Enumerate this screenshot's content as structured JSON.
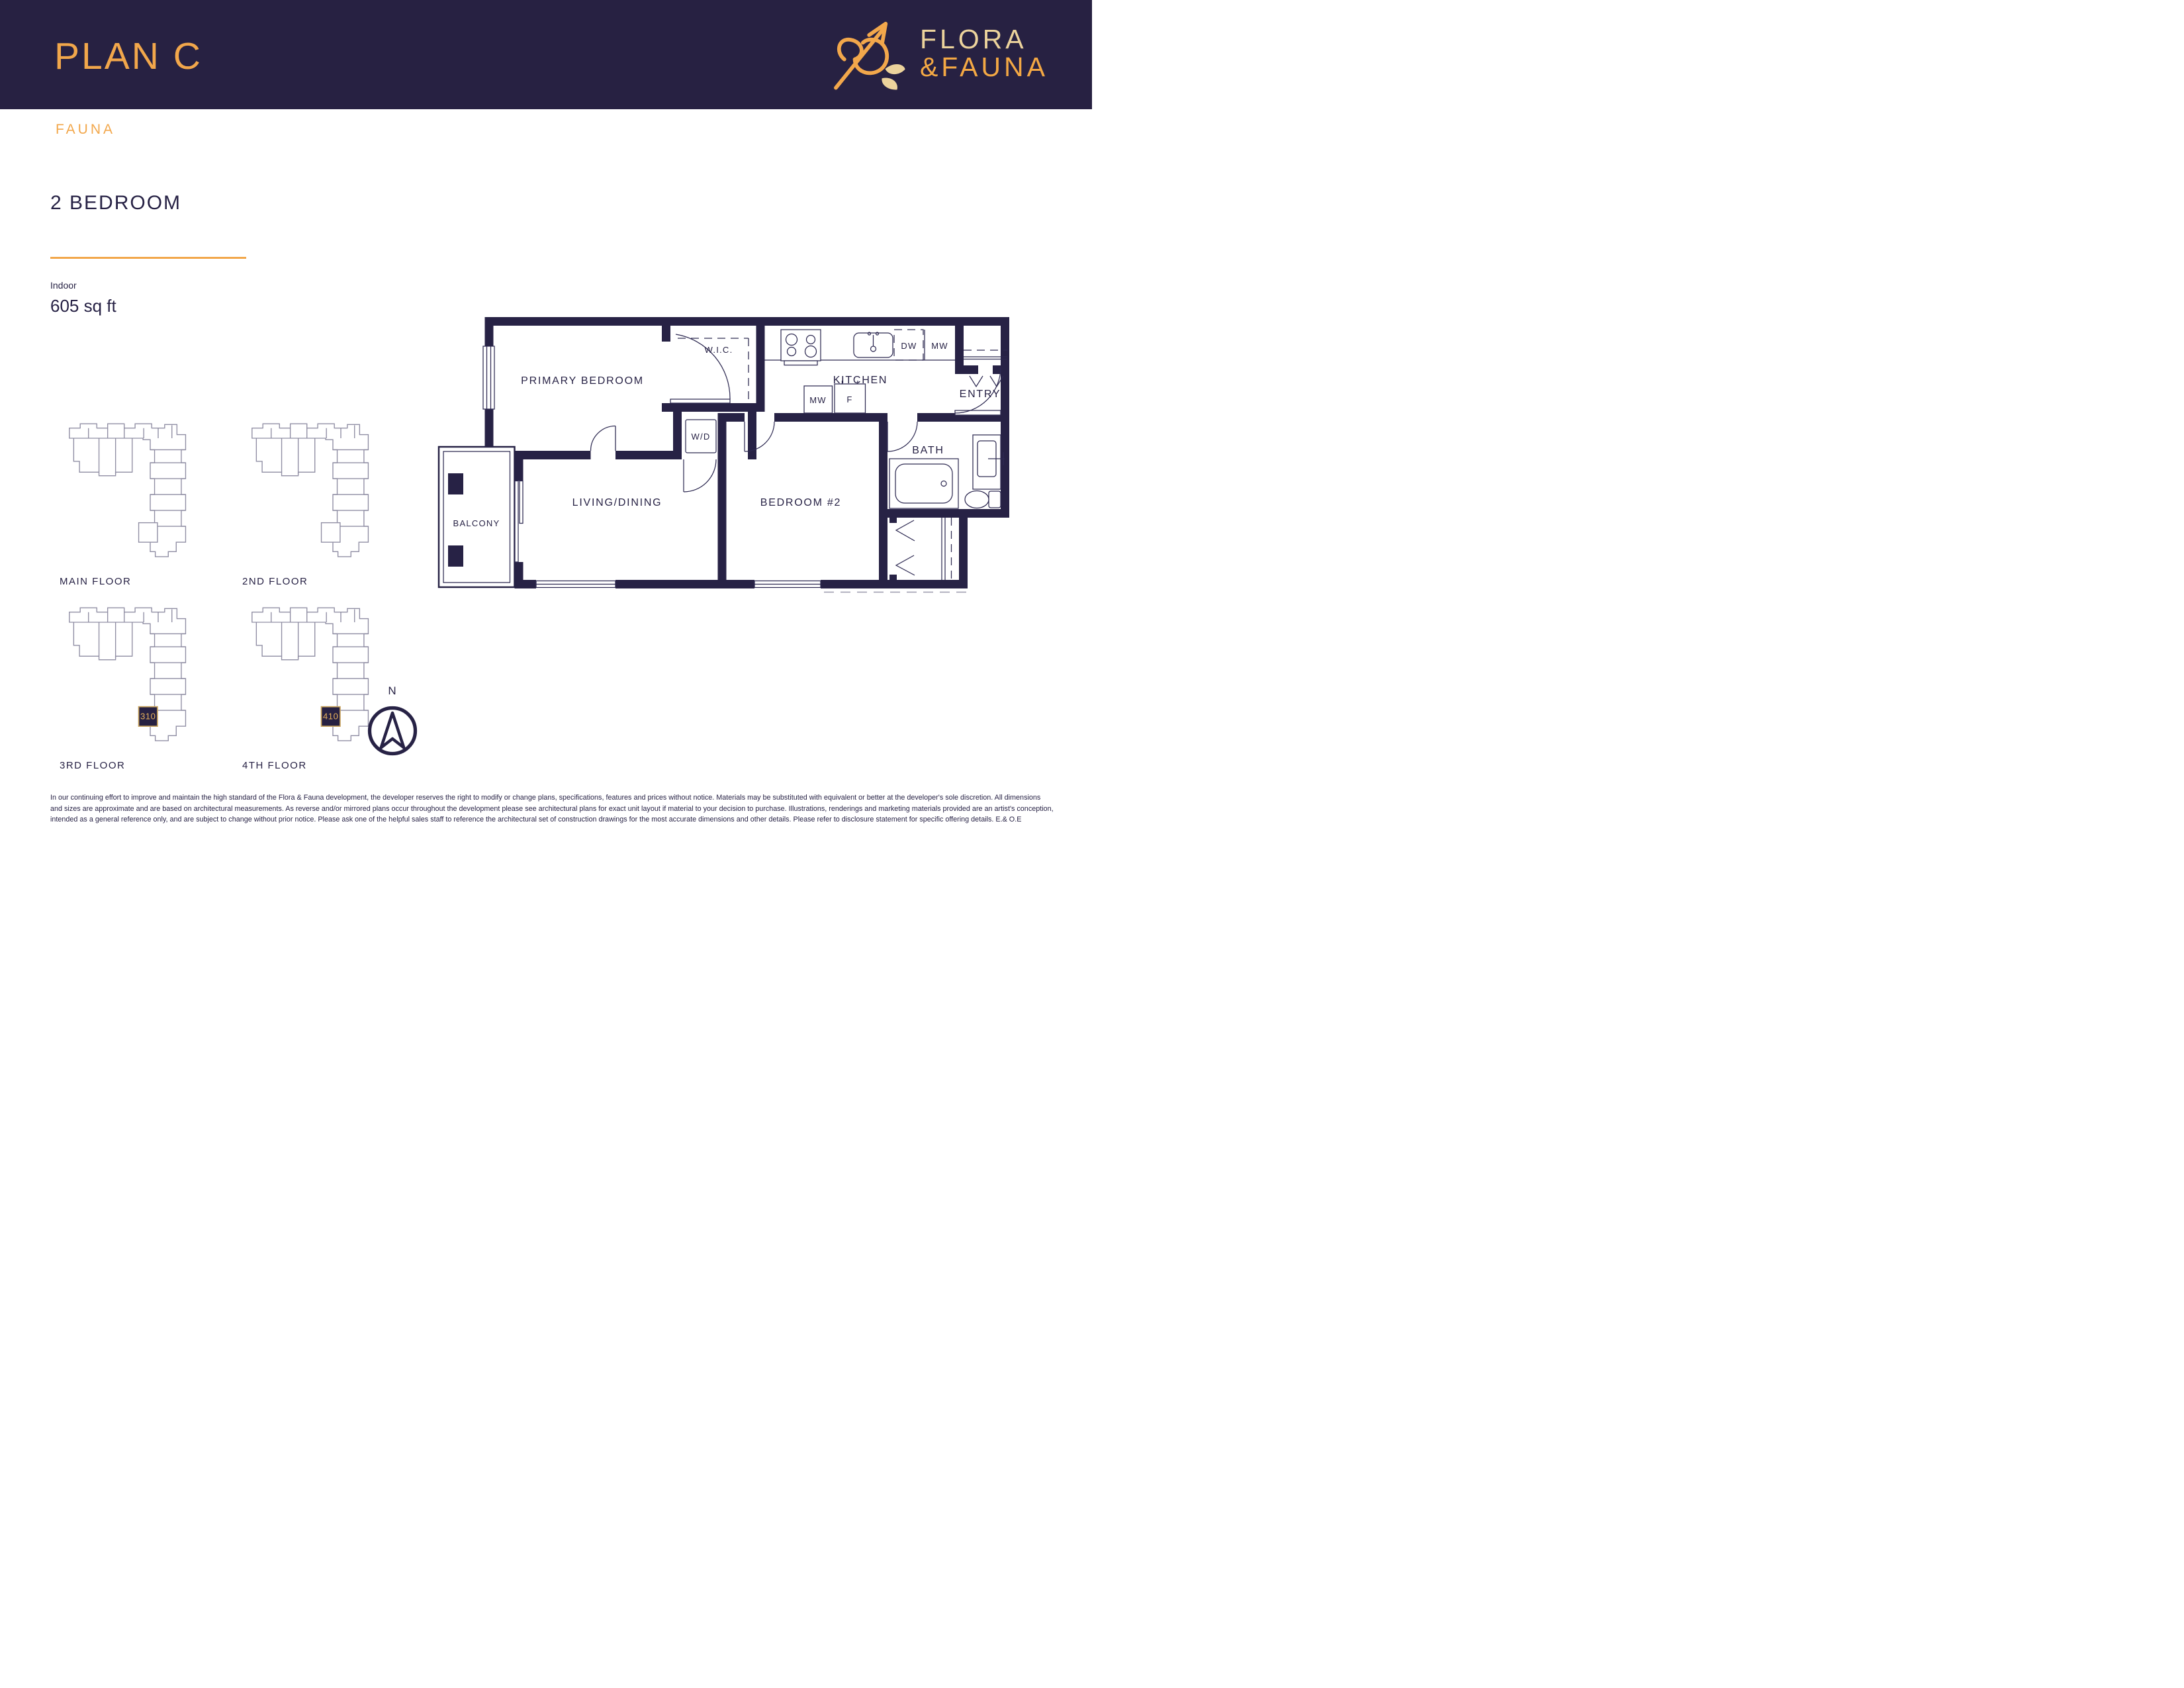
{
  "colors": {
    "navy": "#272142",
    "gold": "#F2A74B",
    "pale_gold": "#ECD39C",
    "keyplan_line": "#8F8DA3",
    "unit_badge_border": "#C9A45C"
  },
  "header": {
    "plan_title": "PLAN C",
    "brand": {
      "line1": "FLORA",
      "line2": "&FAUNA"
    },
    "collection": "FAUNA"
  },
  "unit": {
    "heading": "2 BEDROOM",
    "indoor_label": "Indoor",
    "indoor_area": "605 sq ft"
  },
  "keyplans": [
    {
      "label": "MAIN FLOOR",
      "unit": ""
    },
    {
      "label": "2ND FLOOR",
      "unit": ""
    },
    {
      "label": "3RD FLOOR",
      "unit": "310"
    },
    {
      "label": "4TH FLOOR",
      "unit": "410"
    }
  ],
  "floorplan": {
    "rooms": {
      "primary_bedroom": "PRIMARY BEDROOM",
      "wic": "W.I.C.",
      "kitchen": "KITCHEN",
      "entry": "ENTRY",
      "wd": "W/D",
      "bath": "BATH",
      "living_dining": "LIVING/DINING",
      "bedroom2": "BEDROOM #2",
      "balcony": "BALCONY"
    },
    "appliances": {
      "dw": "DW",
      "mw_counter": "MW",
      "mw_wall": "MW",
      "fridge": "F"
    }
  },
  "compass": {
    "north": "N"
  },
  "disclaimer": "In our continuing effort to improve and maintain the high standard of the Flora & Fauna development, the developer reserves the right to modify or change plans, specifications, features and prices without notice. Materials may be substituted with equivalent or better at the developer's sole discretion. All dimensions and sizes are approximate and are based on architectural measurements. As reverse and/or mirrored plans occur throughout the development please see architectural plans for exact unit layout if material to your decision to purchase. Illustrations, renderings and marketing materials provided are an artist's conception, intended as a general reference only, and are subject to change without prior notice. Please ask one of the helpful sales staff to reference the architectural set of construction drawings for the most accurate dimensions and other details. Please refer to disclosure statement for specific offering details. E.& O.E"
}
